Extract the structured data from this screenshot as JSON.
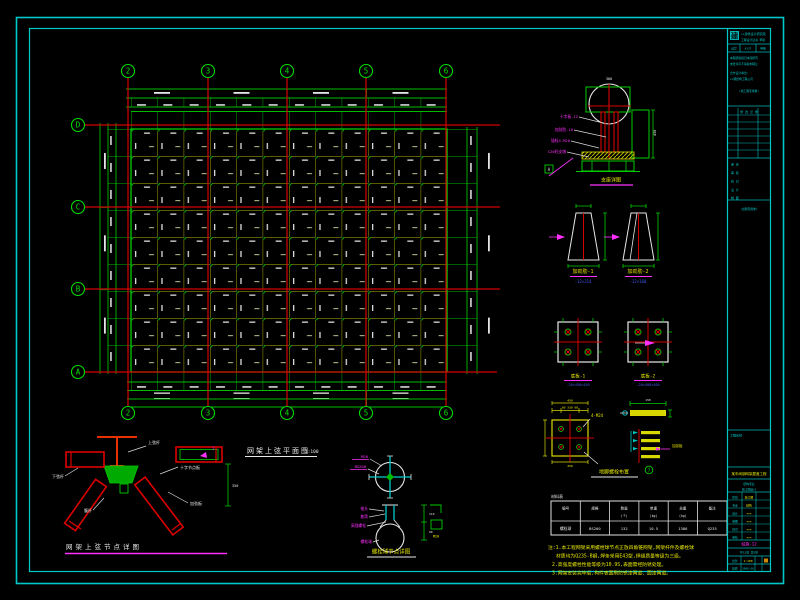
{
  "plan": {
    "title": "网架上弦平面图",
    "scale": "1:100",
    "axes_top": [
      "2",
      "3",
      "4",
      "5",
      "6"
    ],
    "axes_bottom": [
      "2",
      "3",
      "4",
      "5",
      "6"
    ],
    "axes_left": [
      "D",
      "C",
      "B",
      "A"
    ]
  },
  "details": {
    "support": {
      "title": "支座详图",
      "top": "300",
      "dim1": "450",
      "weld": "A",
      "labels": [
        "十字板-12",
        "加劲肋-10",
        "锚栓4-M20",
        "C20砼支墩"
      ]
    },
    "rib1": {
      "title": "加劲肋-1",
      "sub": "-12×214"
    },
    "rib2": {
      "title": "加劲肋-2",
      "sub": "-12×160"
    },
    "plate1": {
      "title": "底板-1",
      "sub": "-20×450×450"
    },
    "plate2": {
      "title": "底板-2",
      "sub": "-20×400×400"
    },
    "anchor": {
      "title": "地脚螺栓布置",
      "bolt": "4-M24",
      "dims_top": "60 330 60",
      "dims_top2": "450",
      "dims_bot": "450"
    },
    "stack": {
      "num": "7",
      "label": "加劲板",
      "dim": "150"
    },
    "weldnode": {
      "title": "网架上弦节点详图",
      "mark": "1",
      "dim": "350",
      "labels": [
        "上弦杆",
        "十字节点板",
        "加劲板",
        "腹杆",
        "下弦杆"
      ]
    },
    "boltball": {
      "title": "螺栓球节点详图",
      "mark": "M20",
      "dim1": "110",
      "dim2": "60",
      "top_labels": [
        "M20",
        "BS200"
      ],
      "labels": [
        "锥头",
        "套筒",
        "高强螺栓",
        "螺栓球"
      ]
    }
  },
  "table": {
    "caption": "材料表",
    "h": [
      [
        "编号",
        ""
      ],
      [
        "规格",
        ""
      ],
      [
        "数量",
        "(个)"
      ],
      [
        "单重",
        "(kg)"
      ],
      [
        "总重",
        "(kg)"
      ],
      [
        "备注",
        ""
      ]
    ],
    "row": [
      "螺栓球",
      "BS200",
      "132",
      "10.5",
      "1386",
      "Q235"
    ]
  },
  "notes": [
    "注:1.本工程网架采用螺栓球节点正放四角锥网架,网架杆件及螺栓球",
    "材质均为Q235-B钢,焊条采用E43型,焊缝质量等级为三级。",
    "2.高强度螺栓性能等级为10.9S,表面需经防锈处理。",
    "3.网架安装完毕后,构件表面刷防锈漆两道、面漆两道。"
  ],
  "titleblock": {
    "logo": "建",
    "company": "××建筑设计研究院",
    "cert": "工程设计证书 甲级",
    "c1": "证号",
    "c2": "A137",
    "c3": "甲级",
    "info1": "本图纸版权归本院所有",
    "info2": "未经许可不得复制转让",
    "info3": "合作设计单位:",
    "info4": "××钢结构工程公司",
    "info5": "(施工图专用章)",
    "rev": "修 改 记 录",
    "s1": "审 定",
    "s2": "审 核",
    "s3": "校 对",
    "s4": "设 计",
    "s5": "制 图",
    "stamp": "(出图专用章)",
    "project_label": "工程名称",
    "project": "某车间钢网架屋盖工程",
    "sub1": "结构专业",
    "sub2": "施工图设计",
    "rows": [
      [
        "阶段",
        "施工图"
      ],
      [
        "专业",
        "结构"
      ],
      [
        "设计",
        "×××"
      ],
      [
        "制图",
        "×××"
      ],
      [
        "校对",
        "×××"
      ],
      [
        "审核",
        "×××"
      ]
    ],
    "dwg_no": "结施-12",
    "sheets": "共12张 第5张",
    "scale_label": "比例",
    "scale": "1:100",
    "date_label": "日期",
    "date": "2008.06"
  }
}
